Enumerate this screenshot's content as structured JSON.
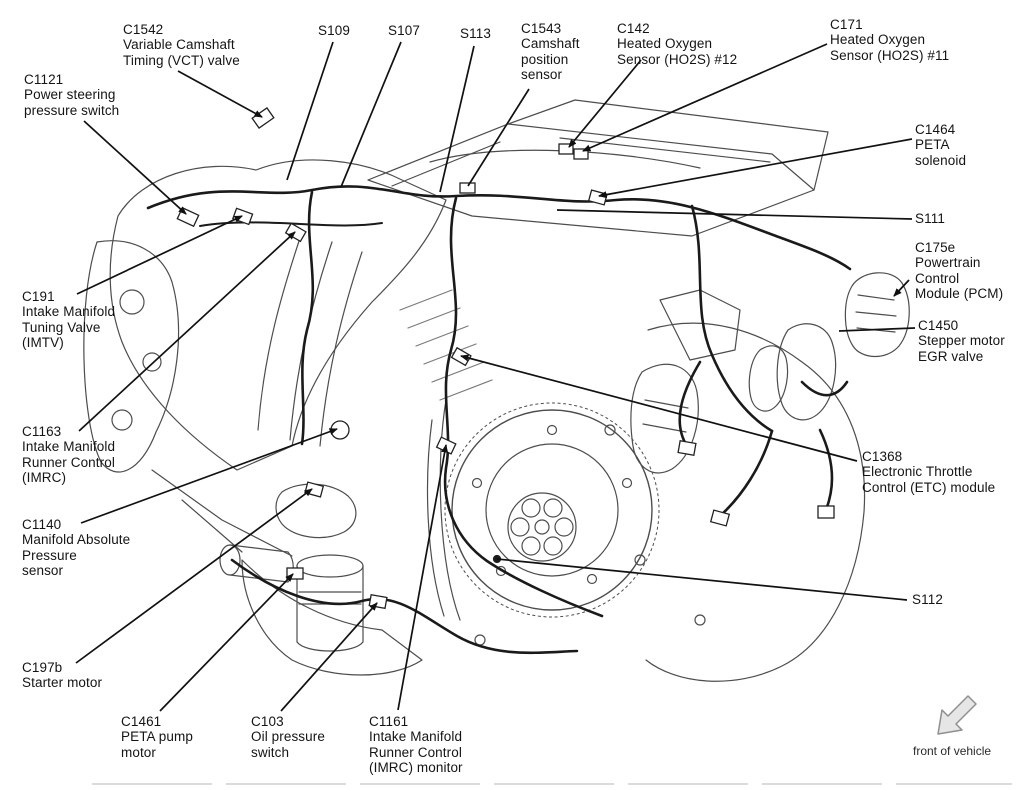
{
  "diagram": {
    "kind": "engine-connector-location-diagram",
    "orientation_note": "front of vehicle"
  },
  "colors": {
    "ink": "#141414",
    "leader_line": "#111111",
    "line_art": "#4d4d4d",
    "harness": "#1a1a1a",
    "arrow_fill": "#e6e6e6",
    "arrow_stroke": "#8f8f8f"
  },
  "labels": {
    "c1542": {
      "code": "C1542",
      "text": "C1542\nVariable Camshaft\nTiming (VCT) valve"
    },
    "c1121": {
      "code": "C1121",
      "text": "C1121\nPower steering\npressure switch"
    },
    "s109": {
      "code": "S109",
      "text": "S109"
    },
    "s107": {
      "code": "S107",
      "text": "S107"
    },
    "s113": {
      "code": "S113",
      "text": "S113"
    },
    "c1543": {
      "code": "C1543",
      "text": "C1543\nCamshaft\nposition\nsensor"
    },
    "c142": {
      "code": "C142",
      "text": "C142\nHeated Oxygen\nSensor (HO2S) #12"
    },
    "c171": {
      "code": "C171",
      "text": "C171\nHeated Oxygen\nSensor (HO2S) #11"
    },
    "c1464": {
      "code": "C1464",
      "text": "C1464\nPETA\nsolenoid"
    },
    "s111": {
      "code": "S111",
      "text": "S111"
    },
    "c175e": {
      "code": "C175e",
      "text": "C175e\nPowertrain\nControl\nModule (PCM)"
    },
    "c1450": {
      "code": "C1450",
      "text": "C1450\nStepper motor\nEGR valve"
    },
    "c191": {
      "code": "C191",
      "text": "C191\nIntake Manifold\nTuning Valve\n(IMTV)"
    },
    "c1163": {
      "code": "C1163",
      "text": "C1163\nIntake Manifold\nRunner Control\n(IMRC)"
    },
    "c1140": {
      "code": "C1140",
      "text": "C1140\nManifold Absolute\nPressure\nsensor"
    },
    "c197b": {
      "code": "C197b",
      "text": "C197b\nStarter motor"
    },
    "c1461": {
      "code": "C1461",
      "text": "C1461\nPETA pump\nmotor"
    },
    "c103": {
      "code": "C103",
      "text": "C103\nOil pressure\nswitch"
    },
    "c1161": {
      "code": "C1161",
      "text": "C1161\nIntake Manifold\nRunner Control\n(IMRC) monitor"
    },
    "c1368": {
      "code": "C1368",
      "text": "C1368\nElectronic Throttle\nControl (ETC) module"
    },
    "s112": {
      "code": "S112",
      "text": "S112"
    },
    "front_of_vehicle": {
      "text": "front of vehicle"
    }
  }
}
